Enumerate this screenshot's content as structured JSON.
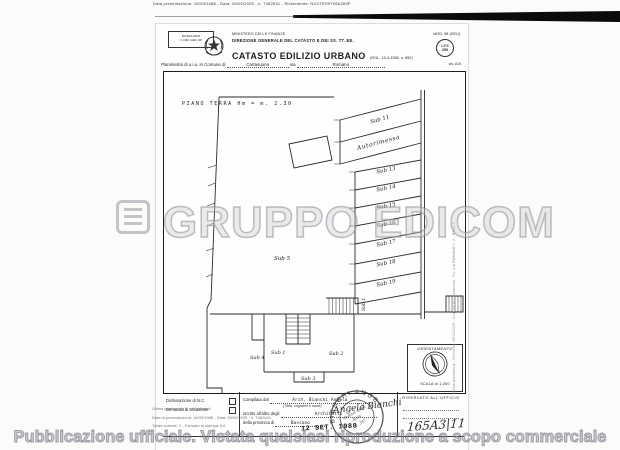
{
  "colors": {
    "ink": "#1f1f1f",
    "paper": "#fefefd",
    "watermark_gray": "#8c8c96",
    "band_black": "#0b0b0b"
  },
  "scan_header": {
    "microtext": "Data presentazione: 16/09/1988 - Data: 26/02/2025 - n. T482541 - Richiedente: NVXTRS9T06A269P"
  },
  "doc_header": {
    "modulario_line1": "MODULARIO",
    "modulario_line2": "F. DIR. GEN. 98",
    "ministry": "MINISTERO DELLE FINANZE",
    "direction": "DIREZIONE GENERALE DEL CATASTO E DEI SS. TT. EE.",
    "title": "CATASTO EDILIZIO URBANO",
    "title_ref": "(ROL. 13-4-1938, n. 652)",
    "mod_right": "MOD. 98 (DEU)",
    "lire_label": "LIRE",
    "lire_value": "250",
    "civ": "civ. A.B."
  },
  "planimetria": {
    "prefix": "Planimetria di u.i.u. in Comune di",
    "comune": "Cartasuona",
    "via_label": "via",
    "via_value": "Romano"
  },
  "plan": {
    "floor_label": "PIANO TERRA  Hm = m. 2.30",
    "stalls": [
      "Sub 11",
      "Autorimessa",
      "Sub 13",
      "Sub 14",
      "Sub 15",
      "Sub 16",
      "Sub 17",
      "Sub 18",
      "Sub 19"
    ],
    "sub5": "Sub 5",
    "sub4": "Sub 4",
    "sub1": "Sub 1",
    "sub2": "Sub 2",
    "sub3": "Sub 3",
    "stair_label": "Sub 1",
    "orientation_label": "ORIENTAMENTO",
    "scale_label": "SCALA di 1:200"
  },
  "form": {
    "decl_nc": "Dichiarazione di N.C.",
    "decl_var": "Denuncia di variazione",
    "compiled_label": "Compilata dal",
    "compiled_value": "Arch. Bianchi Angela",
    "compiled_caption": "(Titolo, cognome e nome)",
    "albo_label": "Iscritto all'albo degli",
    "albo_value": "Architetti",
    "prov_label": "della provincia di",
    "prov_value": "Bassano",
    "date_stamp": "12 SET. 1988",
    "signature": "Angela Bianchi",
    "reserved": "RISERVATO ALL'UFFICIO",
    "handwritten_ref": "165A3|11"
  },
  "stamp": {
    "arc": "BIANCHI ANGELO",
    "inner1": "Ordine degli",
    "inner2": "Arch.",
    "inner3": "n. 347"
  },
  "watermark": {
    "brand": "GRUPPO EDICOM",
    "footer": "Pubblicazione ufficiale. Vietata qualsiasi riproduzione a scopo commerciale"
  },
  "overlay": {
    "line1": "Ultima planimetria in atti catastali",
    "line2": "Data di presentazione: 16/09/1988 - Data: 26/02/2025 - n. T482541",
    "line3": "Totale schede: 1 - Formato di stampa: A4"
  },
  "side_text": {
    "line1": "Ultima planimetria - Richiesta: 26/02/2025 - Comune di Cartasuona - Fo.",
    "line2": "VIA ROMANO n. 2 - Piano T"
  }
}
